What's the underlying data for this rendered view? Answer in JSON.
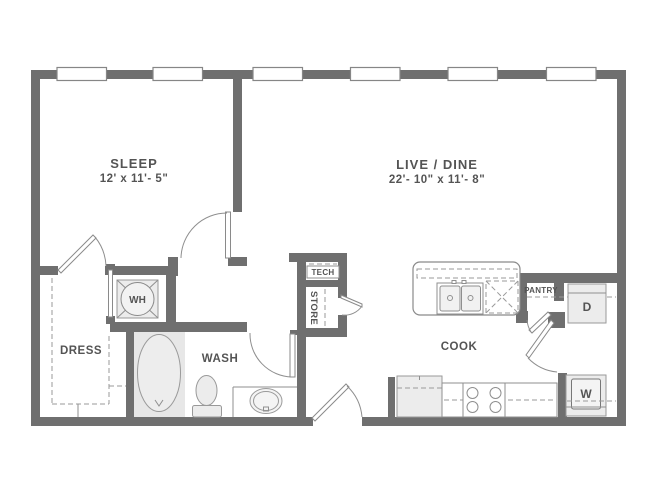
{
  "plan": {
    "title": "One-bedroom apartment floor plan",
    "rooms": {
      "sleep": {
        "name": "SLEEP",
        "dims": "12' x 11'- 5\""
      },
      "live_dine": {
        "name": "LIVE / DINE",
        "dims": "22'- 10\" x 11'- 8\""
      },
      "dress": {
        "name": "DRESS"
      },
      "wash": {
        "name": "WASH"
      },
      "cook": {
        "name": "COOK"
      },
      "tech": {
        "name": "TECH"
      },
      "store": {
        "name": "STORE"
      },
      "pantry": {
        "name": "PANTRY"
      }
    },
    "fixtures": {
      "water_heater": "WH",
      "dryer": "D",
      "washer": "W"
    },
    "window_count": 6,
    "colors": {
      "wall": "#6f6f6f",
      "line": "#8f8f8f",
      "label": "#545454",
      "fixture_fill": "#ececec",
      "background": "#ffffff"
    }
  }
}
